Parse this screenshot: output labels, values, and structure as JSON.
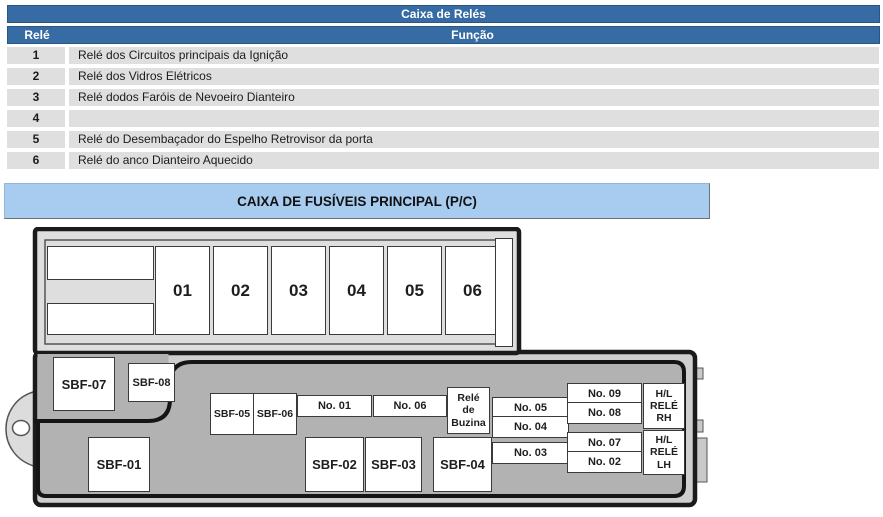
{
  "relay_table": {
    "title": "Caixa de Relés",
    "columns": [
      "Relé",
      "Função"
    ],
    "rows": [
      {
        "num": "1",
        "func": "Relé dos Circuitos principais da Ignição"
      },
      {
        "num": "2",
        "func": "Relé dos Vidros Elétricos"
      },
      {
        "num": "3",
        "func": "Relé dodos Faróis de Nevoeiro Dianteiro"
      },
      {
        "num": "4",
        "func": ""
      },
      {
        "num": "5",
        "func": "Relé do Desembaçador do Espelho Retrovisor da porta"
      },
      {
        "num": "6",
        "func": "Relé do anco Dianteiro Aquecido"
      }
    ]
  },
  "fusebox": {
    "title": "CAIXA DE FUSÍVEIS PRINCIPAL (P/C)",
    "top_fuses": [
      "01",
      "02",
      "03",
      "04",
      "05",
      "06"
    ],
    "slots": {
      "sbf01": "SBF-01",
      "sbf02": "SBF-02",
      "sbf03": "SBF-03",
      "sbf04": "SBF-04",
      "sbf05": "SBF-05",
      "sbf06": "SBF-06",
      "sbf07": "SBF-07",
      "sbf08": "SBF-08",
      "no01": "No. 01",
      "no02": "No. 02",
      "no03": "No. 03",
      "no04": "No. 04",
      "no05": "No. 05",
      "no06": "No. 06",
      "no07": "No. 07",
      "no08": "No. 08",
      "no09": "No. 09",
      "horn_relay": "Relé\nde\nBuzina",
      "hl_relay_rh": "H/L\nRELÉ\nRH",
      "hl_relay_lh": "H/L\nRELÉ\nLH"
    }
  },
  "colors": {
    "header_blue": "#376ba3",
    "banner_blue": "#a8ccf0",
    "row_gray": "#dfdfdf",
    "box_outline": "#1b1b1b",
    "inner_gray": "#b2b2b2",
    "panel_gray": "#dedede"
  }
}
